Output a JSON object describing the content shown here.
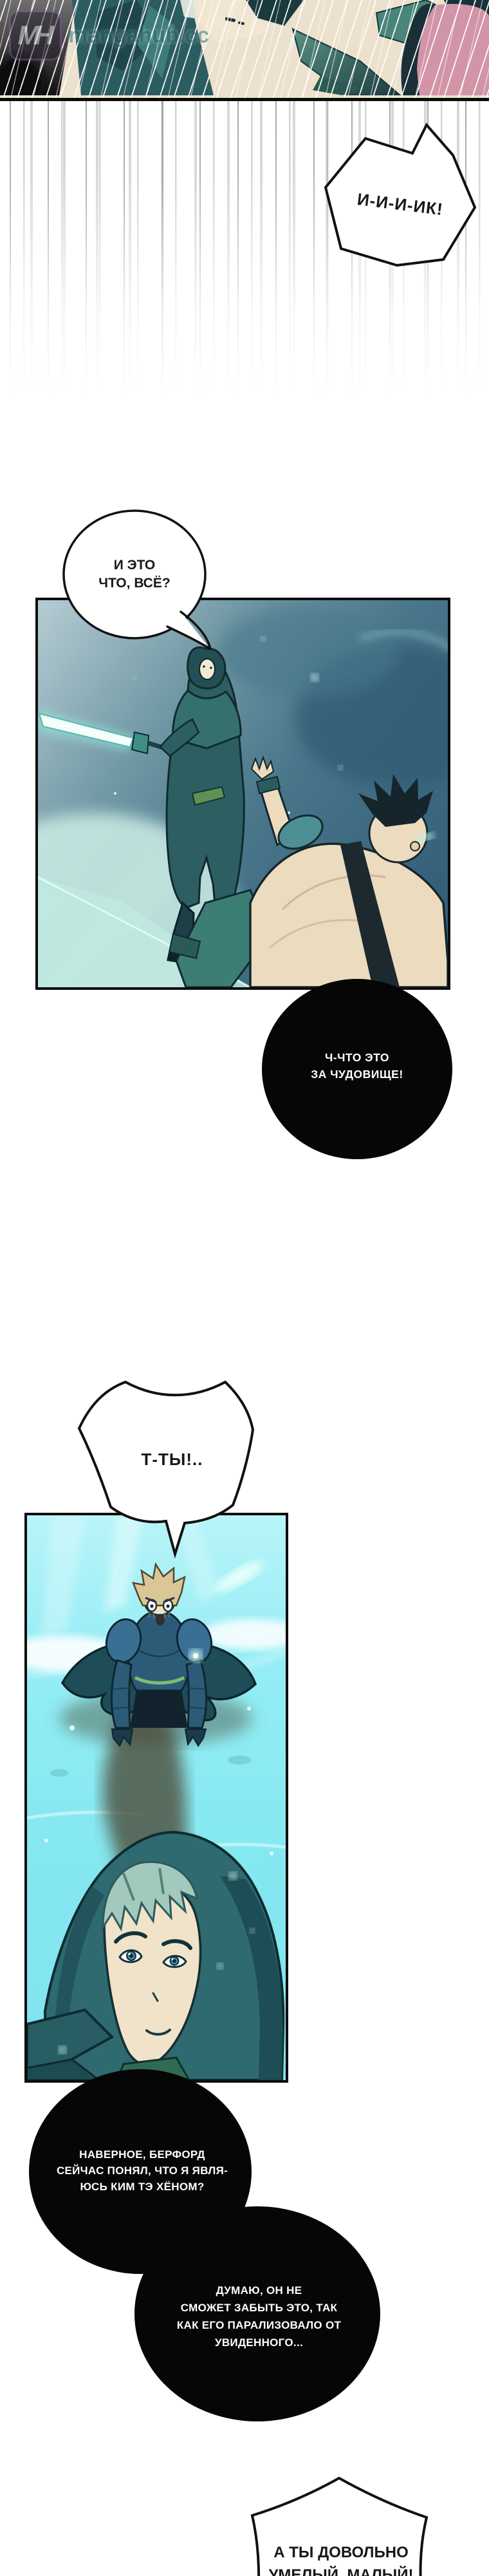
{
  "watermark": {
    "initials": "MH",
    "site": "mangahub.cc"
  },
  "speech": {
    "shriek": {
      "text": "И-И-И-ИК!"
    },
    "is_that_all": {
      "lines": [
        "И ЭТО",
        "ЧТО, ВСЁ?"
      ]
    },
    "monster": {
      "lines": [
        "Ч-ЧТО ЭТО",
        "ЗА ЧУДОВИЩЕ!"
      ]
    },
    "you": {
      "text": "Т-ТЫ!.."
    },
    "realization": {
      "lines": [
        "НАВЕРНОЕ, БЕРФОРД",
        "СЕЙЧАС ПОНЯЛ, ЧТО Я ЯВЛЯ-",
        "ЮСЬ КИМ ТЭ ХЁНОМ?"
      ]
    },
    "paralyzed": {
      "lines": [
        "ДУМАЮ, ОН НЕ",
        "СМОЖЕТ ЗАБЫТЬ ЭТО, ТАК",
        "КАК ЕГО ПАРАЛИЗОВАЛО ОТ",
        "УВИДЕННОГО..."
      ]
    },
    "skilled": {
      "lines": [
        "А ТЫ ДОВОЛЬНО",
        "УМЕЛЫЙ, МАЛЫЙ!"
      ]
    }
  },
  "colors": {
    "paper": "#ffffff",
    "ink": "#101010",
    "black_bubble": "#060606",
    "black_bubble_text": "#ffffff",
    "top_panel_cream": "#ece1cd",
    "top_panel_pink": "#d294a7",
    "panel1_light": "#b6ccd3",
    "panel1_dark": "#35607a",
    "panel1_glow": "#d7f2e9",
    "sword_glow": "#8fe5da",
    "cloak_teal": "#2e6a70",
    "panel2_sky": "#9ff0f7",
    "panel2_water": "#7fe3ee",
    "armor_blue": "#2c5b77",
    "hair_blond": "#d9c795",
    "hair_pale_teal": "#a3c9bc",
    "skin": "#ecdbbf",
    "watermark_teal": "#2f6d74"
  }
}
